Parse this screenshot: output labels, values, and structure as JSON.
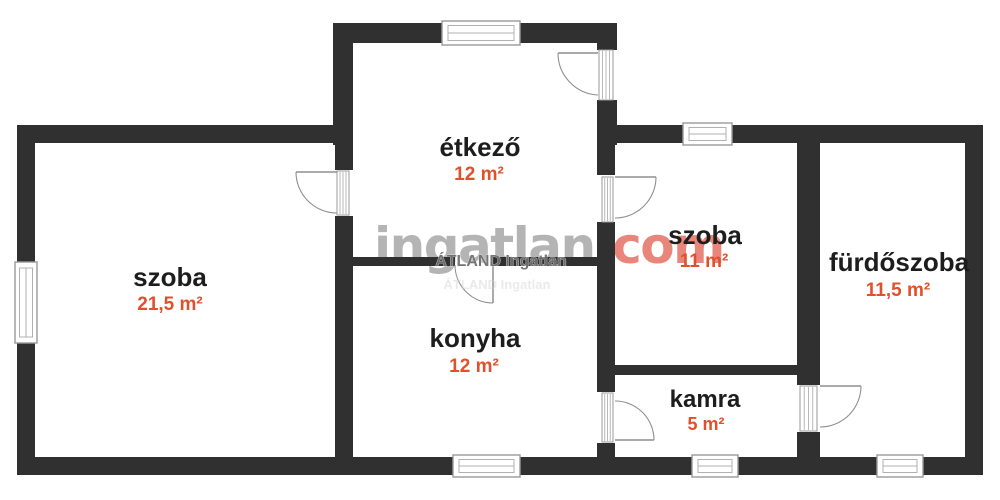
{
  "watermark": {
    "brand_gray": "ingatlan",
    "brand_accent": ".com",
    "agency": "ÁTLAND Ingatlan",
    "agency_ghost": "ÁTLAND Ingatlan"
  },
  "colors": {
    "wall": "#303030",
    "window_stroke": "#9a9a9a",
    "window_inner": "#b0b0b0",
    "door": "#8f8f8f",
    "room_name": "#1d1d1d",
    "room_area": "#df512c",
    "brand_gray": "#b4b4b4",
    "brand_accent": "#e8867c",
    "agency": "#6f6f6f",
    "ghost": "#d2d2d2"
  },
  "rooms": [
    {
      "id": "szoba-nagy",
      "name": "szoba",
      "area": "21,5 m²",
      "nx": 170,
      "ny": 286,
      "ax": 170,
      "ay": 310,
      "ns": 26,
      "as": 19
    },
    {
      "id": "etkezo",
      "name": "étkező",
      "area": "12 m²",
      "nx": 480,
      "ny": 156,
      "ax": 479,
      "ay": 180,
      "ns": 26,
      "as": 19
    },
    {
      "id": "konyha",
      "name": "konyha",
      "area": "12 m²",
      "nx": 475,
      "ny": 347,
      "ax": 474,
      "ay": 372,
      "ns": 26,
      "as": 19
    },
    {
      "id": "szoba-kis",
      "name": "szoba",
      "area": "11 m²",
      "nx": 705,
      "ny": 244,
      "ax": 704,
      "ay": 267,
      "ns": 26,
      "as": 19
    },
    {
      "id": "kamra",
      "name": "kamra",
      "area": "5 m²",
      "nx": 705,
      "ny": 407,
      "ax": 706,
      "ay": 430,
      "ns": 24,
      "as": 18
    },
    {
      "id": "furdoszoba",
      "name": "fürdőszoba",
      "area": "11,5 m²",
      "nx": 899,
      "ny": 271,
      "ax": 898,
      "ay": 296,
      "ns": 26,
      "as": 19
    }
  ],
  "floorplan": {
    "walls": [
      {
        "x": 17,
        "y": 125,
        "w": 18,
        "h": 137
      },
      {
        "x": 17,
        "y": 343,
        "w": 18,
        "h": 132
      },
      {
        "x": 17,
        "y": 125,
        "w": 336,
        "h": 18
      },
      {
        "x": 333,
        "y": 23,
        "w": 20,
        "h": 122
      },
      {
        "x": 333,
        "y": 23,
        "w": 109,
        "h": 20
      },
      {
        "x": 520,
        "y": 23,
        "w": 97,
        "h": 20
      },
      {
        "x": 597,
        "y": 23,
        "w": 20,
        "h": 27
      },
      {
        "x": 597,
        "y": 100,
        "w": 20,
        "h": 45
      },
      {
        "x": 597,
        "y": 125,
        "w": 86,
        "h": 18
      },
      {
        "x": 732,
        "y": 125,
        "w": 251,
        "h": 18
      },
      {
        "x": 965,
        "y": 125,
        "w": 18,
        "h": 350
      },
      {
        "x": 17,
        "y": 457,
        "w": 436,
        "h": 18
      },
      {
        "x": 520,
        "y": 457,
        "w": 172,
        "h": 18
      },
      {
        "x": 738,
        "y": 457,
        "w": 139,
        "h": 18
      },
      {
        "x": 923,
        "y": 457,
        "w": 60,
        "h": 18
      },
      {
        "x": 335,
        "y": 143,
        "w": 18,
        "h": 27
      },
      {
        "x": 335,
        "y": 216,
        "w": 18,
        "h": 241
      },
      {
        "x": 597,
        "y": 143,
        "w": 18,
        "h": 32
      },
      {
        "x": 597,
        "y": 222,
        "w": 18,
        "h": 170
      },
      {
        "x": 597,
        "y": 443,
        "w": 18,
        "h": 14
      },
      {
        "x": 353,
        "y": 257,
        "w": 102,
        "h": 9
      },
      {
        "x": 493,
        "y": 257,
        "w": 104,
        "h": 9
      },
      {
        "x": 615,
        "y": 365,
        "w": 185,
        "h": 10
      },
      {
        "x": 797,
        "y": 143,
        "w": 23,
        "h": 242
      },
      {
        "x": 797,
        "y": 432,
        "w": 23,
        "h": 25
      }
    ],
    "windows": [
      {
        "x": 442,
        "y": 21,
        "w": 78,
        "h": 24
      },
      {
        "x": 683,
        "y": 123,
        "w": 49,
        "h": 22
      },
      {
        "x": 15,
        "y": 262,
        "w": 22,
        "h": 81
      },
      {
        "x": 453,
        "y": 455,
        "w": 67,
        "h": 22
      },
      {
        "x": 692,
        "y": 455,
        "w": 46,
        "h": 22
      },
      {
        "x": 877,
        "y": 455,
        "w": 46,
        "h": 22
      }
    ],
    "door_jambs": [
      {
        "x": 599,
        "y": 50,
        "w": 14,
        "h": 50
      },
      {
        "x": 337,
        "y": 171,
        "w": 12,
        "h": 44
      },
      {
        "x": 602,
        "y": 177,
        "w": 11,
        "h": 45
      },
      {
        "x": 602,
        "y": 393,
        "w": 11,
        "h": 49
      },
      {
        "x": 800,
        "y": 386,
        "w": 17,
        "h": 45
      }
    ],
    "doors": [
      {
        "leaf": [
          598,
          53,
          558,
          53
        ],
        "arc": "M 558,53 A 42,42 0 0 0 598,95"
      },
      {
        "leaf": [
          337,
          172,
          296,
          172
        ],
        "arc": "M 296,172 A 41,41 0 0 0 337,213"
      },
      {
        "leaf": [
          615,
          177,
          656,
          177
        ],
        "arc": "M 656,177 A 41,41 0 0 1 615,218"
      },
      {
        "leaf": [
          615,
          440,
          654,
          440
        ],
        "arc": "M 615,401 A 39,39 0 0 1 654,440"
      },
      {
        "leaf": [
          820,
          386,
          861,
          386
        ],
        "arc": "M 861,386 A 41,41 0 0 1 820,427"
      },
      {
        "leaf": [
          493,
          265,
          493,
          303
        ],
        "arc": "M 455,265 A 38,38 0 0 0 493,303"
      }
    ]
  }
}
